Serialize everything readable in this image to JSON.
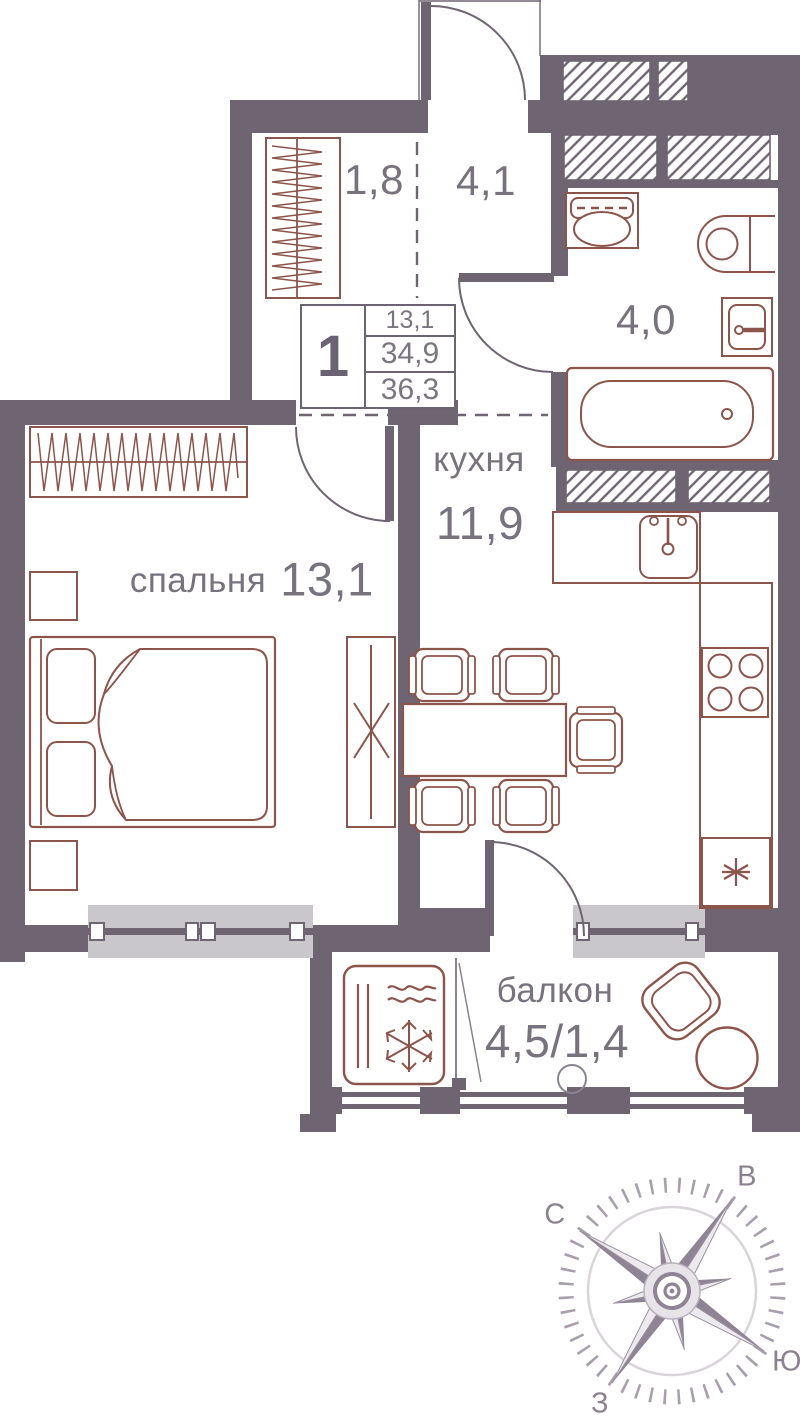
{
  "floor_plan": {
    "unit_info": {
      "rooms_count": "1",
      "area_living": "13,1",
      "area_main": "34,9",
      "area_total": "36,3"
    },
    "rooms": {
      "wardrobe": {
        "area": "1,8"
      },
      "hallway": {
        "area": "4,1"
      },
      "bathroom": {
        "area": "4,0"
      },
      "kitchen": {
        "name": "кухня",
        "area": "11,9"
      },
      "bedroom": {
        "name": "спальня",
        "area": "13,1"
      },
      "balcony": {
        "name": "балкон",
        "area": "4,5/1,4"
      }
    },
    "compass": {
      "north": "С",
      "east": "В",
      "south": "Ю",
      "west": "З"
    },
    "colors": {
      "wall": "#6e6472",
      "fixture": "#8c554b",
      "door": "#6e6472",
      "text": "#77727d",
      "window_sill": "#cac7cc",
      "compass": "#8e8494"
    }
  }
}
